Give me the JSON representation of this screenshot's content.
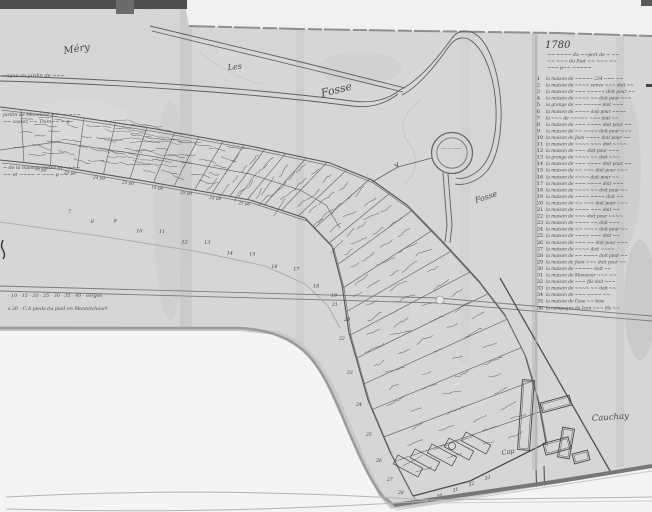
{
  "document": {
    "kind": "photograph of an 18th-century hand-drawn cadastral plan",
    "year": "1780"
  },
  "colors": {
    "photo_background": "#c8c8c8",
    "paper": "#d6d6d6",
    "backing_white": "#f3f3f3",
    "ink": "#4a4a4a",
    "edge_shadow": "#8a8a8a",
    "dark_bar": "#4e4e4e"
  },
  "place_labels": {
    "mery": "Méry",
    "les": "Les",
    "fosse_upper": "Fosse",
    "fosse_lower": "Fosse",
    "cauchay": "Cauchay",
    "cap": "Cap"
  },
  "annotations": {
    "left_margin_note": "~ague au jardin de ~~~",
    "block_a1": "jardin de Monsieur ~~~~ ~~~",
    "block_a2": "~~ costez ~~ Thim~~ ~ p~",
    "block_b1": "~ de la maison costez et ~~~~",
    "block_b2": "~~ et ~~~~ ~ ~~~ p ~~",
    "scale_1": "· 10 · 15 · 20 · 25 · 30 · 35 · 40 · verges",
    "scale_2": "s 20 · C.A pieds du pied en Montelchéart",
    "circle_note": "~~ ~ ~~~"
  },
  "band": {
    "width_labels": [
      "30 pd",
      "25 pd",
      "24 pd",
      "25 pd",
      "15 pd",
      "25 pd",
      "24 pd",
      "25 pd"
    ],
    "plot_numbers_straight": [
      "7",
      "8",
      "9",
      "10",
      "11",
      "12",
      "13",
      "14",
      "15",
      "16",
      "17",
      "18",
      "19",
      "20"
    ],
    "plot_numbers_bend": [
      "21",
      "22",
      "23",
      "24",
      "25",
      "26",
      "27",
      "28"
    ],
    "plot_numbers_cap": [
      "29",
      "30",
      "31",
      "32",
      "33"
    ]
  },
  "legend": {
    "year": "1780",
    "header_lines": [
      "~~ ~~~~ du ~~port de ~ ~~",
      "~~ ~~~ du Sud ~~ ~~~ ~~",
      "~~~ p~~ ~~~~~"
    ],
    "entries": [
      {
        "n": "1",
        "text": "la maison de ~~~~~ 234 ~~~ ~~"
      },
      {
        "n": "2",
        "text": "la maison de ~~~~ venve ~~~ doit ~~"
      },
      {
        "n": "3",
        "text": "la maison de ~~~ ~~~~~ doit pour ~~"
      },
      {
        "n": "4",
        "text": "la maison de ~~~~ ~~ doit pour ~~~"
      },
      {
        "n": "5",
        "text": "la grange de ~~ ~~~~~ doit ~~~"
      },
      {
        "n": "6",
        "text": "la maison de ~~~~ doit pour ~~~~"
      },
      {
        "n": "7",
        "text": "la ~~~ de ~~~~~ ~~~ doit ~~"
      },
      {
        "n": "8",
        "text": "la maison de ~~~ ~~~~ doit pour ~~"
      },
      {
        "n": "9",
        "text": "la maison de ~~ ~~~~ doit pour ~~~"
      },
      {
        "n": "10",
        "text": "la maison de Jean ~~~~ doit pour ~~"
      },
      {
        "n": "11",
        "text": "la maison de ~~~~ ~~~ doit ~~~~"
      },
      {
        "n": "12",
        "text": "la maison de ~~~ doit pour ~~~"
      },
      {
        "n": "13",
        "text": "la grange de ~~~~ ~~ doit ~~~"
      },
      {
        "n": "14",
        "text": "la maison de ~~~ ~~~~ doit pour ~~"
      },
      {
        "n": "15",
        "text": "la maison de ~~ ~~~ doit pour ~~~"
      },
      {
        "n": "16",
        "text": "la maison de ~~~~ doit pour ~~"
      },
      {
        "n": "17",
        "text": "la maison de ~~~ ~~~~ doit ~~~"
      },
      {
        "n": "18",
        "text": "la maison de ~~~~ ~~ doit pour ~~"
      },
      {
        "n": "19",
        "text": "la maison de ~~~~ ~~~~ doit ~~"
      },
      {
        "n": "20",
        "text": "la maison de ~~ ~~~ doit pour ~~~"
      },
      {
        "n": "21",
        "text": "la maison de ~~~~ ~~~ doit ~~"
      },
      {
        "n": "22",
        "text": "la maison de ~~~ doit pour ~~~~"
      },
      {
        "n": "23",
        "text": "la maison de ~~~~ ~~ doit ~~~"
      },
      {
        "n": "24",
        "text": "la maison de ~~ ~~~~ doit pour ~~"
      },
      {
        "n": "25",
        "text": "la maison de ~~~~ ~~~ doit ~~"
      },
      {
        "n": "26",
        "text": "la maison de ~~~ ~~ doit pour ~~~"
      },
      {
        "n": "27",
        "text": "la maison de ~~~~ doit ~~~~"
      },
      {
        "n": "28",
        "text": "la maison de ~~ ~~~~ doit pour ~~"
      },
      {
        "n": "29",
        "text": "la maison de Jean ~~~ doit pour ~~"
      },
      {
        "n": "30",
        "text": "la maison de ~~~~~ doit ~~"
      },
      {
        "n": "31",
        "text": "la maison de Monsieur ~~~ ~~"
      },
      {
        "n": "32",
        "text": "la maison de ~~~ fils doit ~~~"
      },
      {
        "n": "33",
        "text": "la maison de ~~~~ ~~ doit ~~"
      },
      {
        "n": "34",
        "text": "la maison de ~~~ ~~~~ ~~"
      },
      {
        "n": "35",
        "text": "la maison de Case ~~ bois"
      },
      {
        "n": "36",
        "text": "la campagne de Jean ~~~ fils ~~"
      }
    ]
  }
}
